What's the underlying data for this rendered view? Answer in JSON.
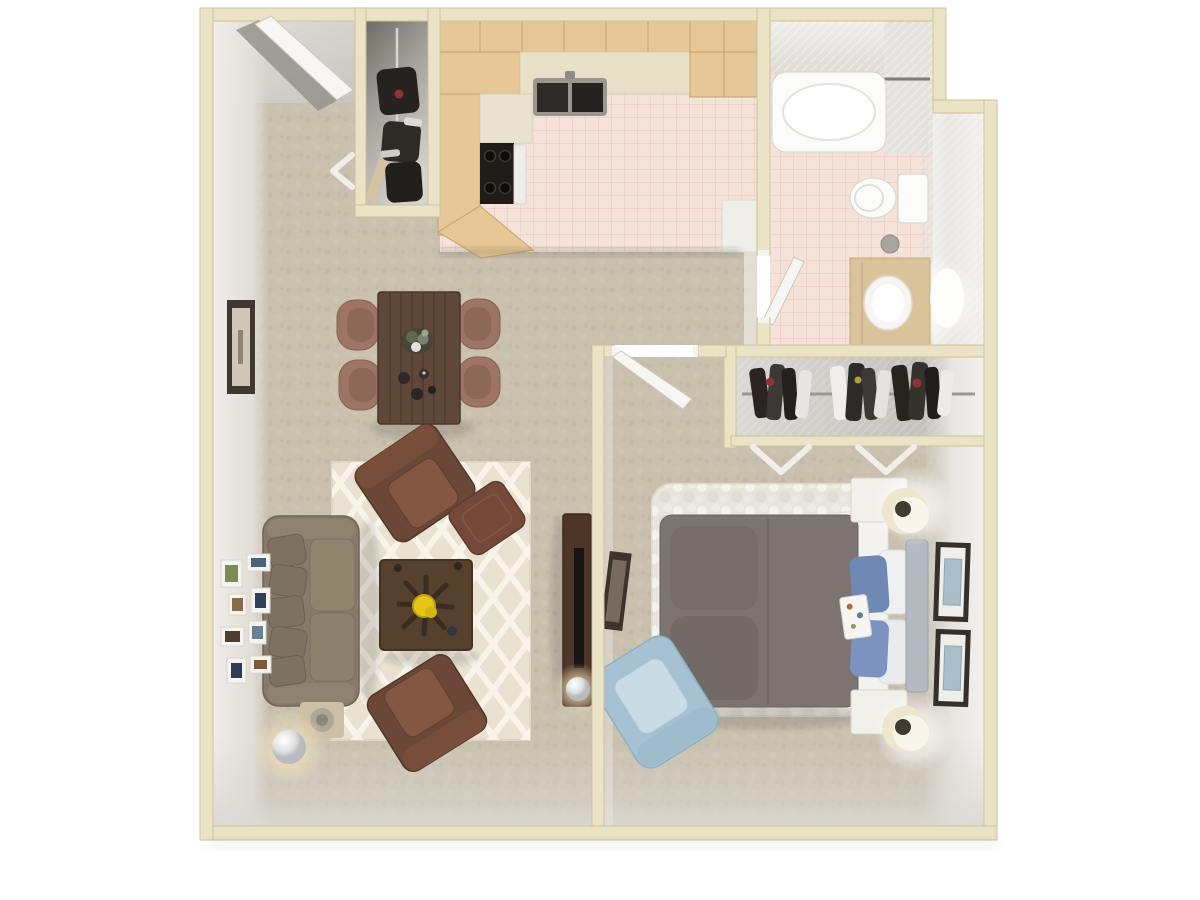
{
  "scene": {
    "type": "3d-floor-plan-top-view",
    "description": "3D rendered top-down floor plan of a one-bedroom, one-bathroom apartment with living/dining area, galley kitchen, entry closet, bedroom with reach-in closet, and full bathroom",
    "canvas": {
      "width": 1200,
      "height": 900
    },
    "text_labels": []
  },
  "palette": {
    "wall": "#eae3c6",
    "wall_edge": "#ccc29c",
    "carpet": "#c9c0ae",
    "tile": "#f5e3da",
    "grout": "#e9ccc2",
    "wood_cabinet": "#e7c795",
    "wood_cabinet_dark": "#c6a26c",
    "counter": "#e9e0c8",
    "gray_face": "#e7e5e0",
    "gray_floor": "#d8d5d0",
    "rug": "#e9e2d1",
    "sofa": "#877a68",
    "sofa_dark": "#6f6455",
    "leather": "#6b4737",
    "leather_seat": "#835741",
    "ottoman": "#74493a",
    "coffee_table": "#55412e",
    "dining_table": "#5f4839",
    "dining_chair": "#9d7466",
    "console": "#4f3526",
    "tv": "#181614",
    "duvet": "#7b7470",
    "sheet": "#f3f2ef",
    "pillow_blue": "#6f88b4",
    "pillow_blue2": "#7c93c0",
    "headboard": "#b2bac2",
    "shag_rug": "#e9e5dc",
    "chair_blue": "#a6c1d2",
    "nightstand": "#f2f0ea",
    "lamp_shade": "#efe6cf",
    "vanity": "#d9c49c",
    "fixture": "#fbfbfa",
    "accent_yellow": "#e5c517",
    "accent_red": "#943136",
    "frame_dark": "#3a332c",
    "art_blue": "#a9bfcc"
  },
  "rooms": [
    {
      "name": "entry",
      "floor": "vinyl-gray",
      "features": [
        "front-door-open",
        "utility-closet-with-shelves",
        "bifold-door-marker"
      ]
    },
    {
      "name": "kitchen",
      "floor": "pink-tile",
      "features": [
        "u-shaped-wood-cabinets",
        "double-sink",
        "range-with-black-cooktop",
        "angled-end-cabinet"
      ]
    },
    {
      "name": "dining-area",
      "floor": "carpet",
      "furniture": [
        "dark-wood-table",
        "four-upholstered-chairs",
        "centerpiece-plant",
        "table-setting"
      ]
    },
    {
      "name": "living-room",
      "floor": "carpet",
      "furniture": [
        "taupe-sofa",
        "two-brown-leather-armchairs",
        "ottoman",
        "square-coffee-table-with-yellow-flowers",
        "trellis-area-rug",
        "media-console-with-tv",
        "sphere-floor-lamp",
        "side-table",
        "gallery-wall-frames",
        "single-wall-frame"
      ]
    },
    {
      "name": "bathroom",
      "floor": "pink-tile",
      "features": [
        "bathtub-with-curtain-rod",
        "toilet",
        "vanity-with-sink",
        "round-mirror",
        "waste-bin"
      ]
    },
    {
      "name": "bedroom",
      "floor": "carpet",
      "furniture": [
        "bed-gray-duvet-blue-pillows",
        "white-shag-rug",
        "two-white-nightstands",
        "two-round-lamps",
        "light-blue-armchair",
        "leaning-frame",
        "two-wall-frames",
        "reach-in-closet-with-clothes",
        "bifold-closet-doors"
      ]
    }
  ]
}
